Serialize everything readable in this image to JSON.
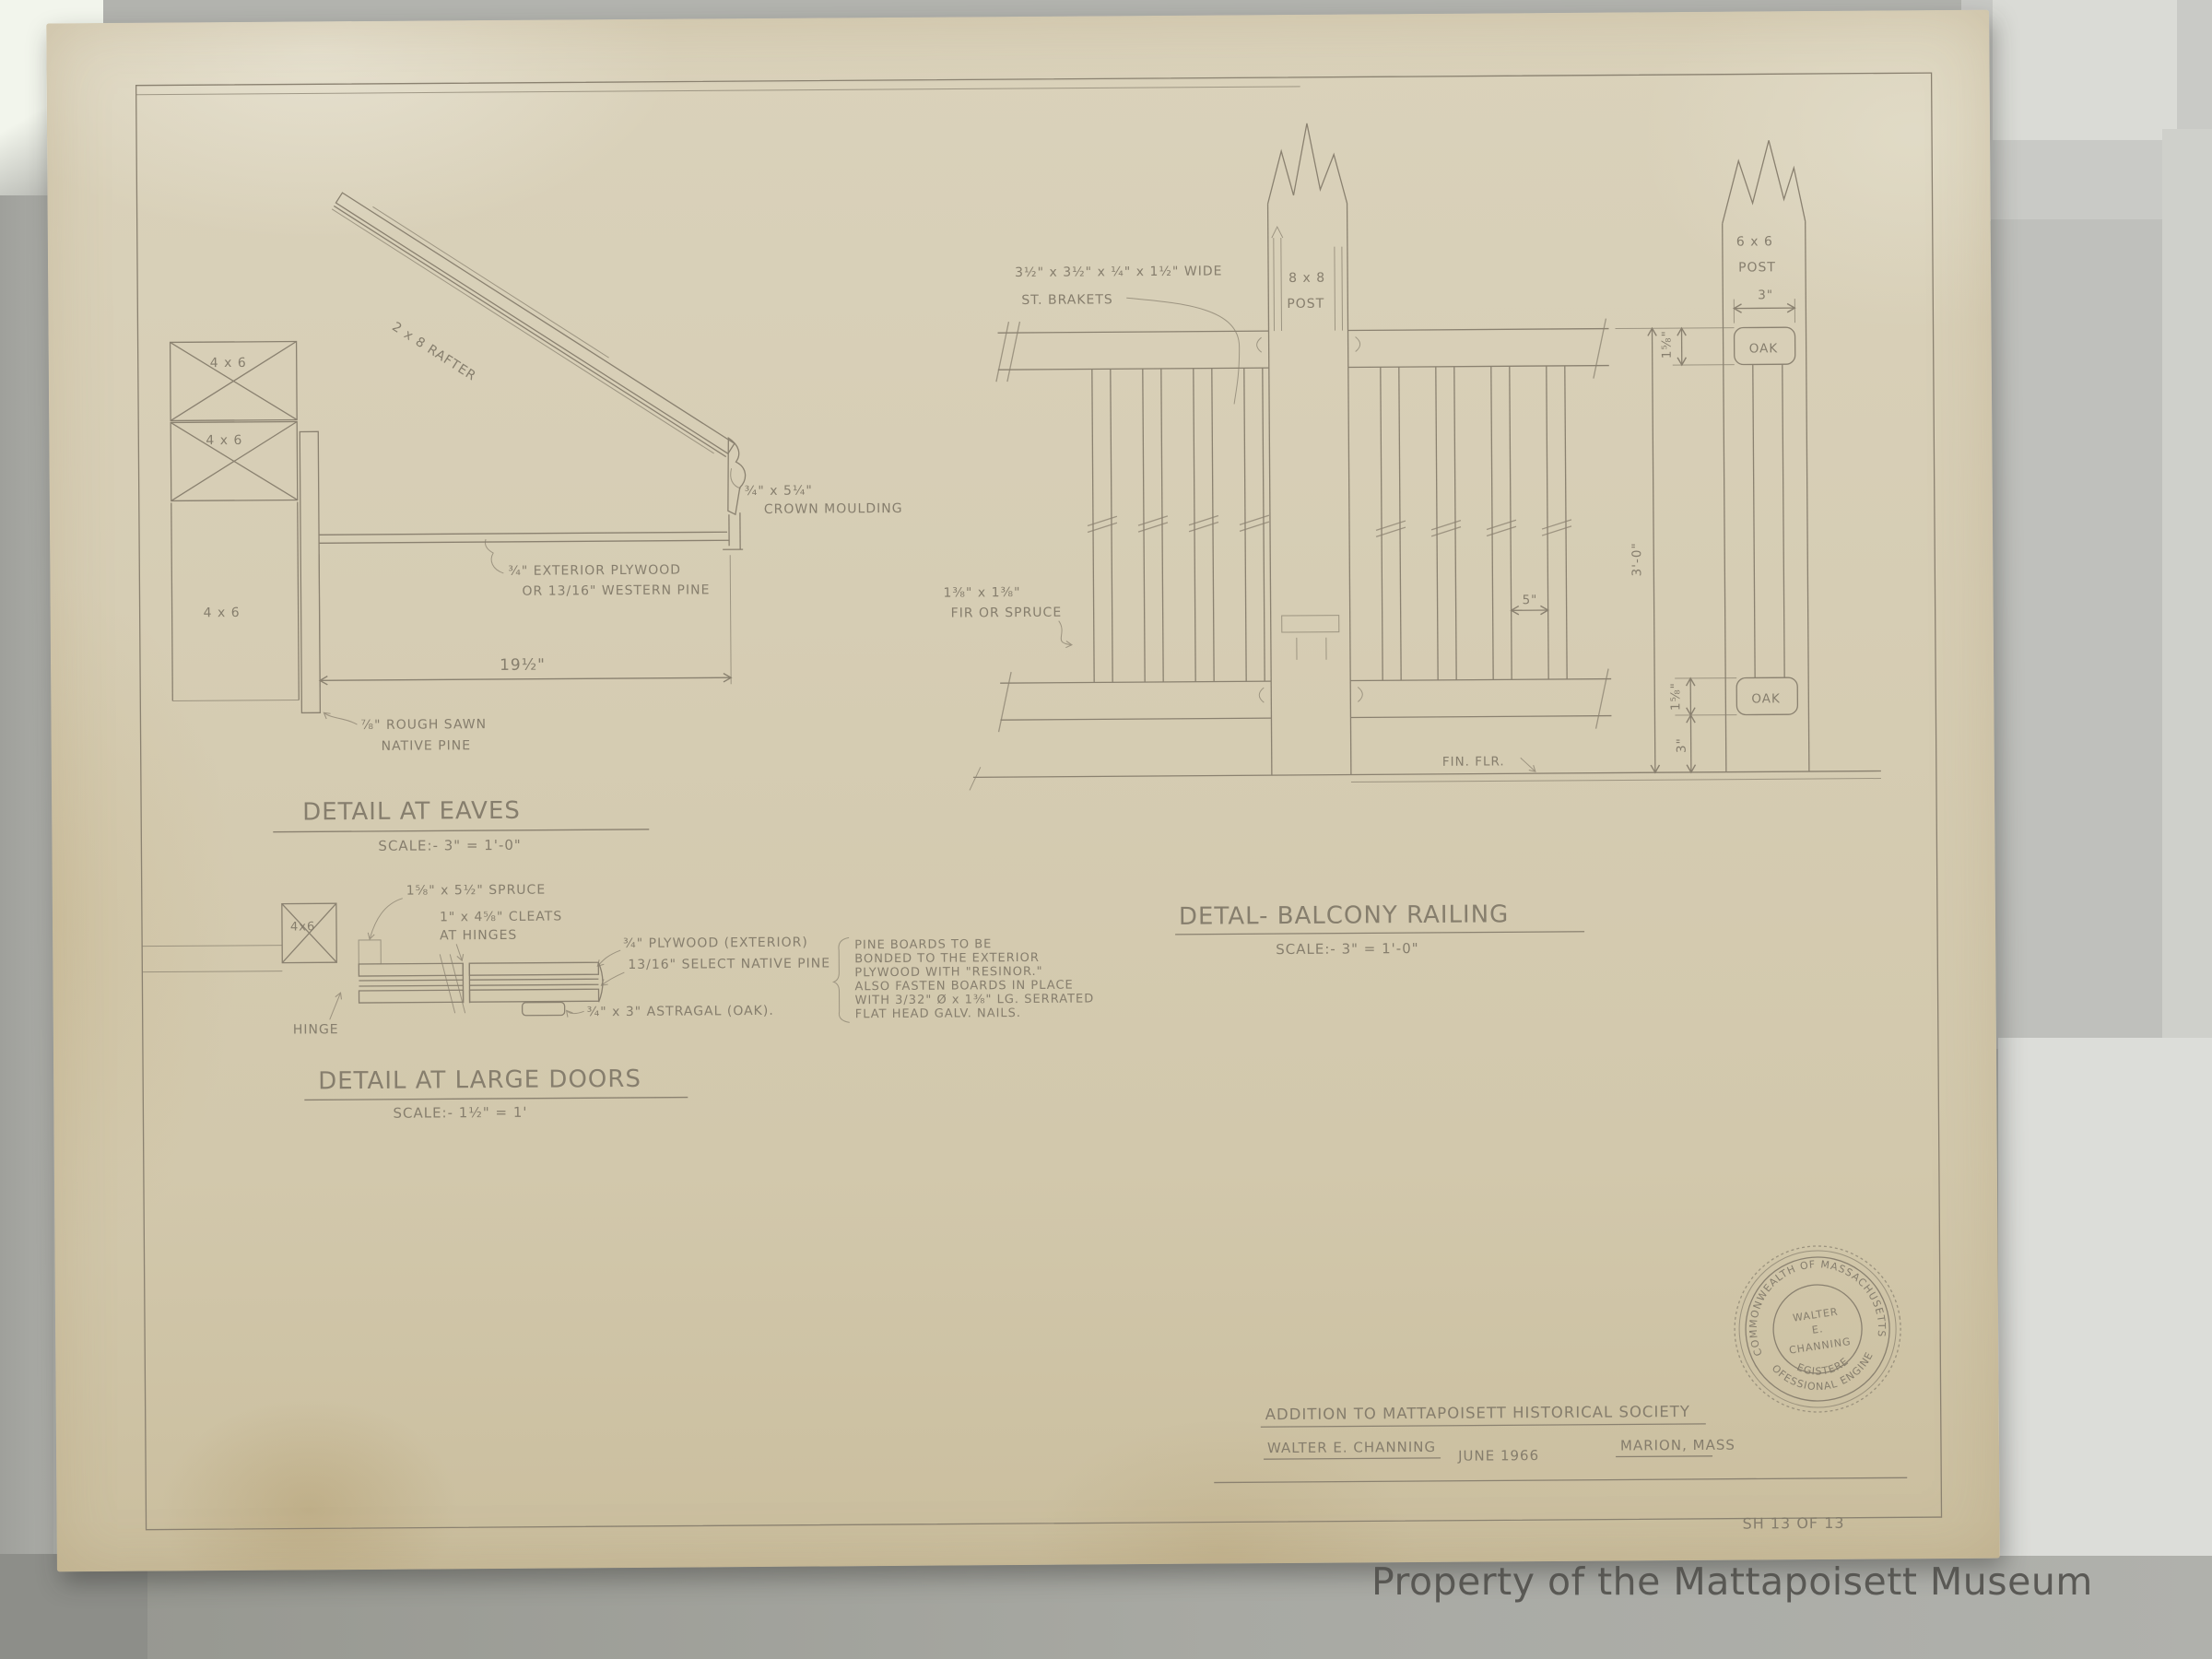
{
  "photo": {
    "watermark": "Property of the Mattapoisett Museum"
  },
  "colors": {
    "paper": "#d6cdb4",
    "pencil": "#8a8170",
    "stamp_ink": "#6f6a5e",
    "watermark": "#4f4e4a",
    "background": "#b2b3ae"
  },
  "sheet": {
    "number": "SH 13 OF 13",
    "title_block": {
      "project": "ADDITION TO MATTAPOISETT HISTORICAL SOCIETY",
      "engineer": "WALTER E. CHANNING",
      "date": "JUNE 1966",
      "location": "MARION, MASS"
    },
    "stamp": {
      "arc_top": "COMMONWEALTH OF MASSACHUSETTS",
      "center_line1": "WALTER",
      "center_line2": "E.",
      "center_line3": "CHANNING",
      "arc_bottom_inner": "REGISTERED",
      "arc_bottom_outer": "PROFESSIONAL ENGINEER"
    }
  },
  "details": {
    "eaves": {
      "title": "DETAIL AT EAVES",
      "scale": "SCALE:- 3\" = 1'-0\"",
      "labels": {
        "rafter": "2 x 8 RAFTER",
        "post_top": "4 x 6",
        "post_mid": "4 x 6",
        "post_bottom": "4 x 6",
        "crown_size": "¾\" x 5¼\"",
        "crown": "CROWN MOULDING",
        "plywood_1": "¾\" EXTERIOR PLYWOOD",
        "plywood_2": "OR 13/16\" WESTERN PINE",
        "dim_soffit": "19½\"",
        "sheathing_1": "⅞\" ROUGH SAWN",
        "sheathing_2": "NATIVE PINE"
      }
    },
    "large_doors": {
      "title": "DETAIL AT LARGE DOORS",
      "scale": "SCALE:- 1½\" = 1'",
      "labels": {
        "frame": "4x6",
        "spruce": "1⅝\" x 5½\" SPRUCE",
        "cleats_1": "1\" x 4⅝\" CLEATS",
        "cleats_2": "AT HINGES",
        "plywood": "¾\" PLYWOOD (EXTERIOR)",
        "pine": "13/16\" SELECT NATIVE PINE",
        "hinge": "HINGE",
        "astragal": "¾\" x 3\" ASTRAGAL (OAK).",
        "note_lines": [
          "PINE BOARDS TO BE",
          "BONDED TO THE EXTERIOR",
          "PLYWOOD WITH \"RESINOR.\"",
          "ALSO FASTEN BOARDS IN PLACE",
          "WITH 3/32\" Ø x 1⅜\" LG. SERRATED",
          "FLAT HEAD GALV. NAILS."
        ]
      }
    },
    "balcony_railing": {
      "title": "DETAL- BALCONY RAILING",
      "scale": "SCALE:- 3\" = 1'-0\"",
      "labels": {
        "brackets_1": "3½\" x 3½\" x ¼\" x 1½\" WIDE",
        "brackets_2": "ST. BRAKETS",
        "post8_1": "8 x 8",
        "post8_2": "POST",
        "post6_1": "6 x 6",
        "post6_2": "POST",
        "fir_1": "1⅜\" x 1⅜\"",
        "fir_2": "FIR OR SPRUCE",
        "oak_top": "OAK",
        "oak_bottom": "OAK",
        "fin_flr": "FIN. FLR.",
        "dim_3ft": "3'-0\"",
        "dim_3in_top": "3\"",
        "dim_158_top": "1⅝\"",
        "dim_158_bottom": "1⅝\"",
        "dim_3in_bottom": "3\"",
        "dim_5": "5\""
      }
    }
  }
}
